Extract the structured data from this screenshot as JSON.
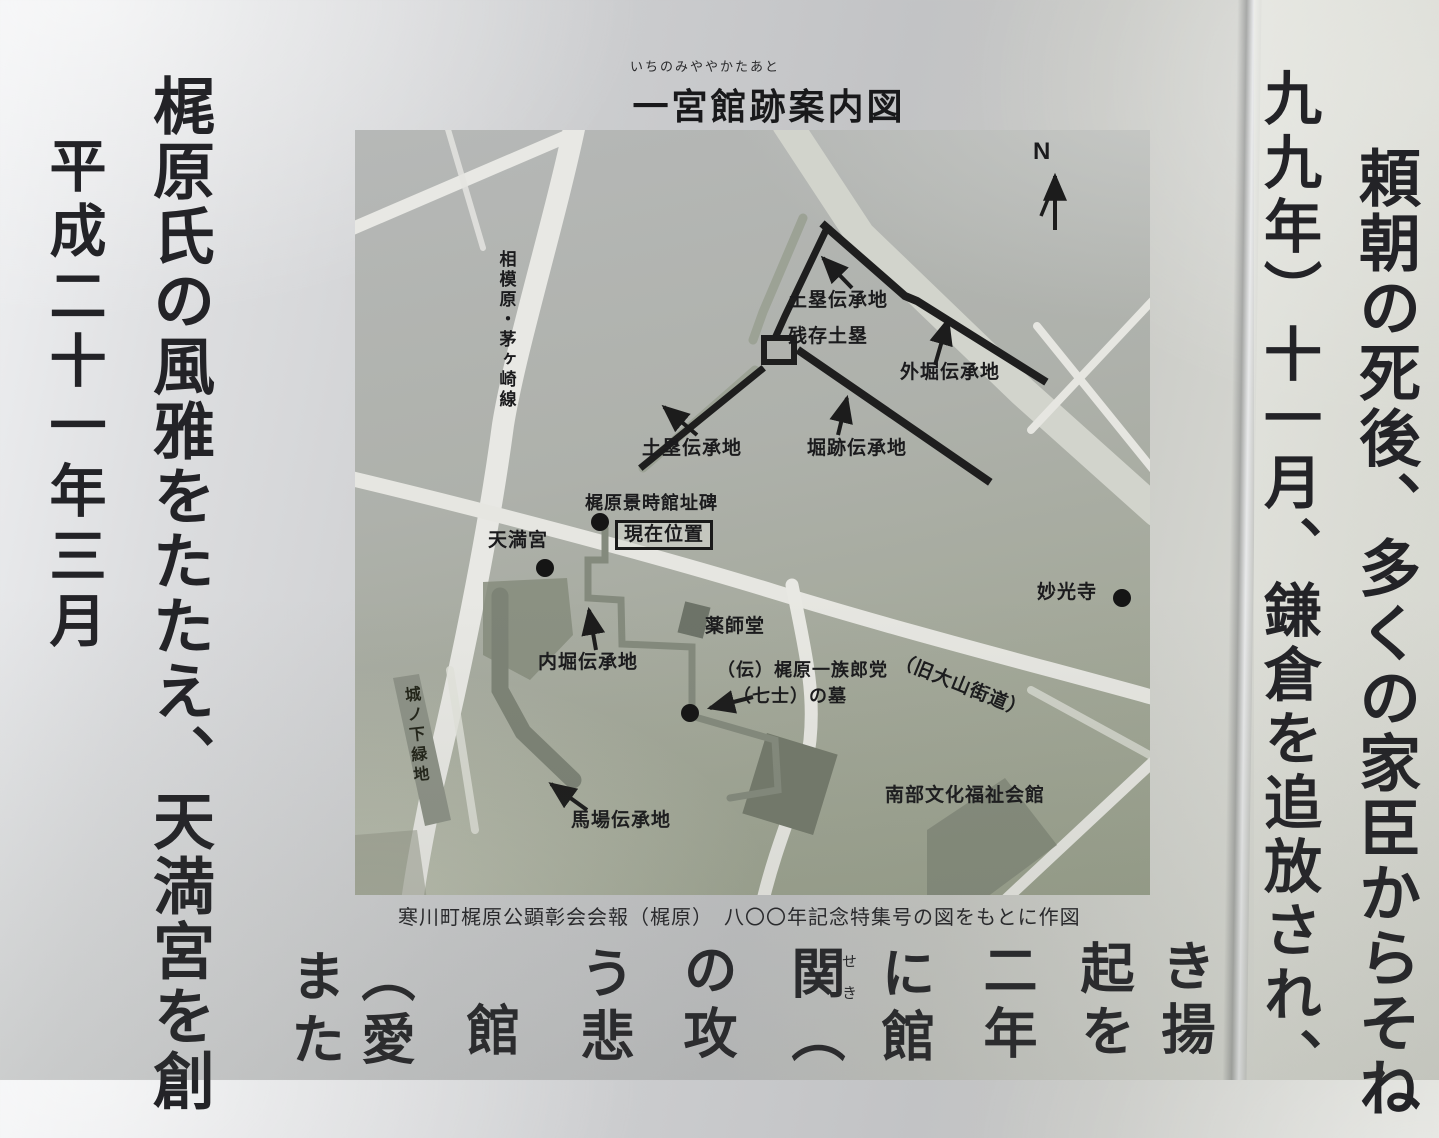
{
  "sign": {
    "title": "一宮館跡案内図",
    "title_furigana": "いちのみややかたあと",
    "caption": "寒川町梶原公顕彰会会報（梶原）　八〇〇年記念特集号の図をもとに作図"
  },
  "left_text": {
    "column_inner": "梶原氏の風雅をたたえ、天満宮を創",
    "column_outer": "平成二十一年三月"
  },
  "right_text": {
    "column_outer": "頼朝の死後、多くの家臣からそね",
    "column_inner": "九九年）十一月、鎌倉を追放され、"
  },
  "map": {
    "compass": "N",
    "labels": {
      "road_sagamihara_chigasaki": "相模原・茅ヶ崎線",
      "dorui_north": "土塁伝承地",
      "zanzon_dorui": "残存土塁",
      "sotobori": "外堀伝承地",
      "dorui_west": "土塁伝承地",
      "horiato": "堀跡伝承地",
      "kajiwara_monument": "梶原景時館址碑",
      "current_location": "現在位置",
      "tenmangu": "天満宮",
      "uchibori": "内堀伝承地",
      "yakushido": "薬師堂",
      "haka_line1": "（伝）梶原一族郎党",
      "haka_line2": "（七士）の墓",
      "myokoji": "妙光寺",
      "kyu_oyama_kaido": "（旧大山街道）",
      "nanbu_kaikan": "南部文化福祉会館",
      "baba": "馬場伝承地",
      "shironoshita_ryokuchi": "城ノ下緑地"
    }
  },
  "bottom_fragments": {
    "f1": "き揚",
    "f2": "起を",
    "f3": "二年",
    "f4": "に館",
    "f5_base": "関",
    "f5_ruby": "せき",
    "f5_after": "（",
    "f6": "の攻",
    "f7": "う悲",
    "f8": "館",
    "f9": "（愛",
    "f10": "また"
  }
}
